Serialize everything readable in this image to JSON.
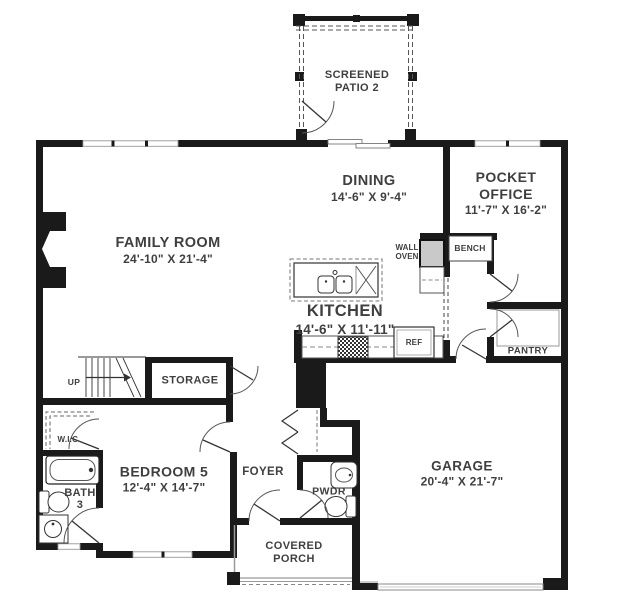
{
  "plan": {
    "rooms": {
      "screened_patio": {
        "line1": "SCREENED",
        "line2": "PATIO 2"
      },
      "family_room": {
        "name": "FAMILY ROOM",
        "dims": "24'-10\" X 21'-4\""
      },
      "dining": {
        "name": "DINING",
        "dims": "14'-6\" X 9'-4\""
      },
      "pocket_office": {
        "line1": "POCKET",
        "line2": "OFFICE",
        "dims": "11'-7\" X 16'-2\""
      },
      "kitchen": {
        "name": "KITCHEN",
        "dims": "14'-6\" X 11'-11\""
      },
      "garage": {
        "name": "GARAGE",
        "dims": "20'-4\" X 21'-7\""
      },
      "bedroom5": {
        "name": "BEDROOM 5",
        "dims": "12'-4\" X 14'-7\""
      },
      "foyer": {
        "name": "FOYER"
      },
      "pwdr": {
        "name": "PWDR"
      },
      "covered_porch": {
        "line1": "COVERED",
        "line2": "PORCH"
      },
      "bath3": {
        "line1": "BATH",
        "line2": "3"
      },
      "wic": {
        "name": "W.I.C."
      },
      "storage": {
        "name": "STORAGE"
      },
      "pantry": {
        "name": "PANTRY"
      }
    },
    "annotations": {
      "bench": "BENCH",
      "wall_oven_line1": "WALL",
      "wall_oven_line2": "OVEN",
      "ref": "REF",
      "up": "UP"
    },
    "colors": {
      "wall": "#1a1a1a",
      "thin_line": "#6b6b6b",
      "text": "#3f3f3f",
      "background": "#ffffff"
    }
  }
}
